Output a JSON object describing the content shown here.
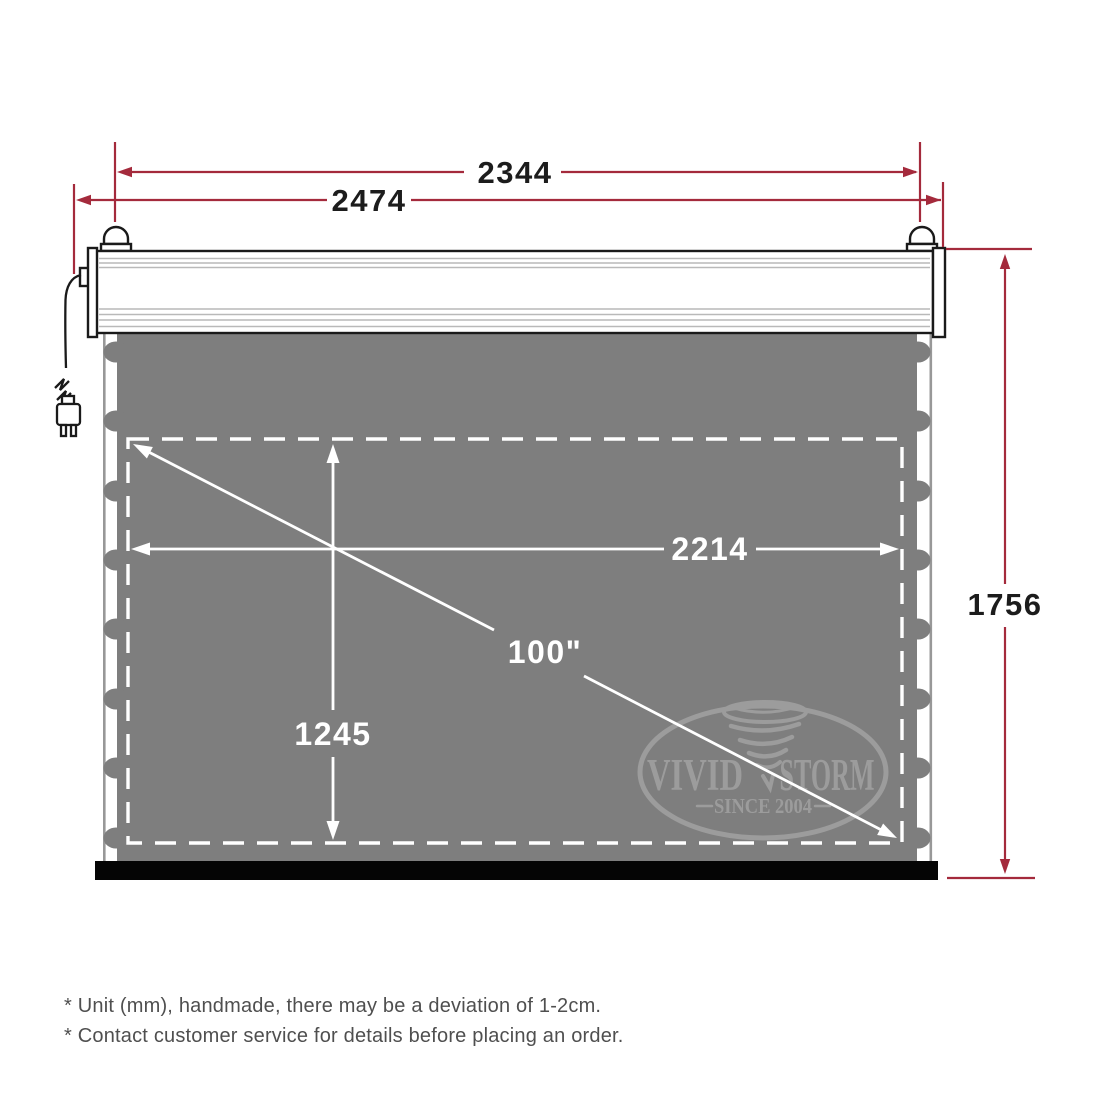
{
  "dimensions": {
    "top_width": "2344",
    "housing_width": "2474",
    "overall_height": "1756",
    "viewing_width": "2214",
    "viewing_height": "1245",
    "diagonal": "100\""
  },
  "watermark": {
    "brand_left": "VIVID",
    "brand_right": "STORM",
    "tagline": "SINCE 2004"
  },
  "footnotes": {
    "line1": "* Unit (mm), handmade, there may be a deviation of 1-2cm.",
    "line2": "* Contact customer service for details before placing an order."
  },
  "icons": {
    "tornado": "tornado-icon",
    "power_plug": "power-plug-icon",
    "mount_bracket": "mount-bracket-icon"
  },
  "colors": {
    "dimension_line": "#a42a3c",
    "dimension_text": "#1c1c1c",
    "screen_fill": "#7e7e7e",
    "screen_label": "#ffffff",
    "watermark_gray": "#9c9c9c",
    "footnote_text": "#4f4f4f",
    "bottom_bar": "#050505"
  }
}
